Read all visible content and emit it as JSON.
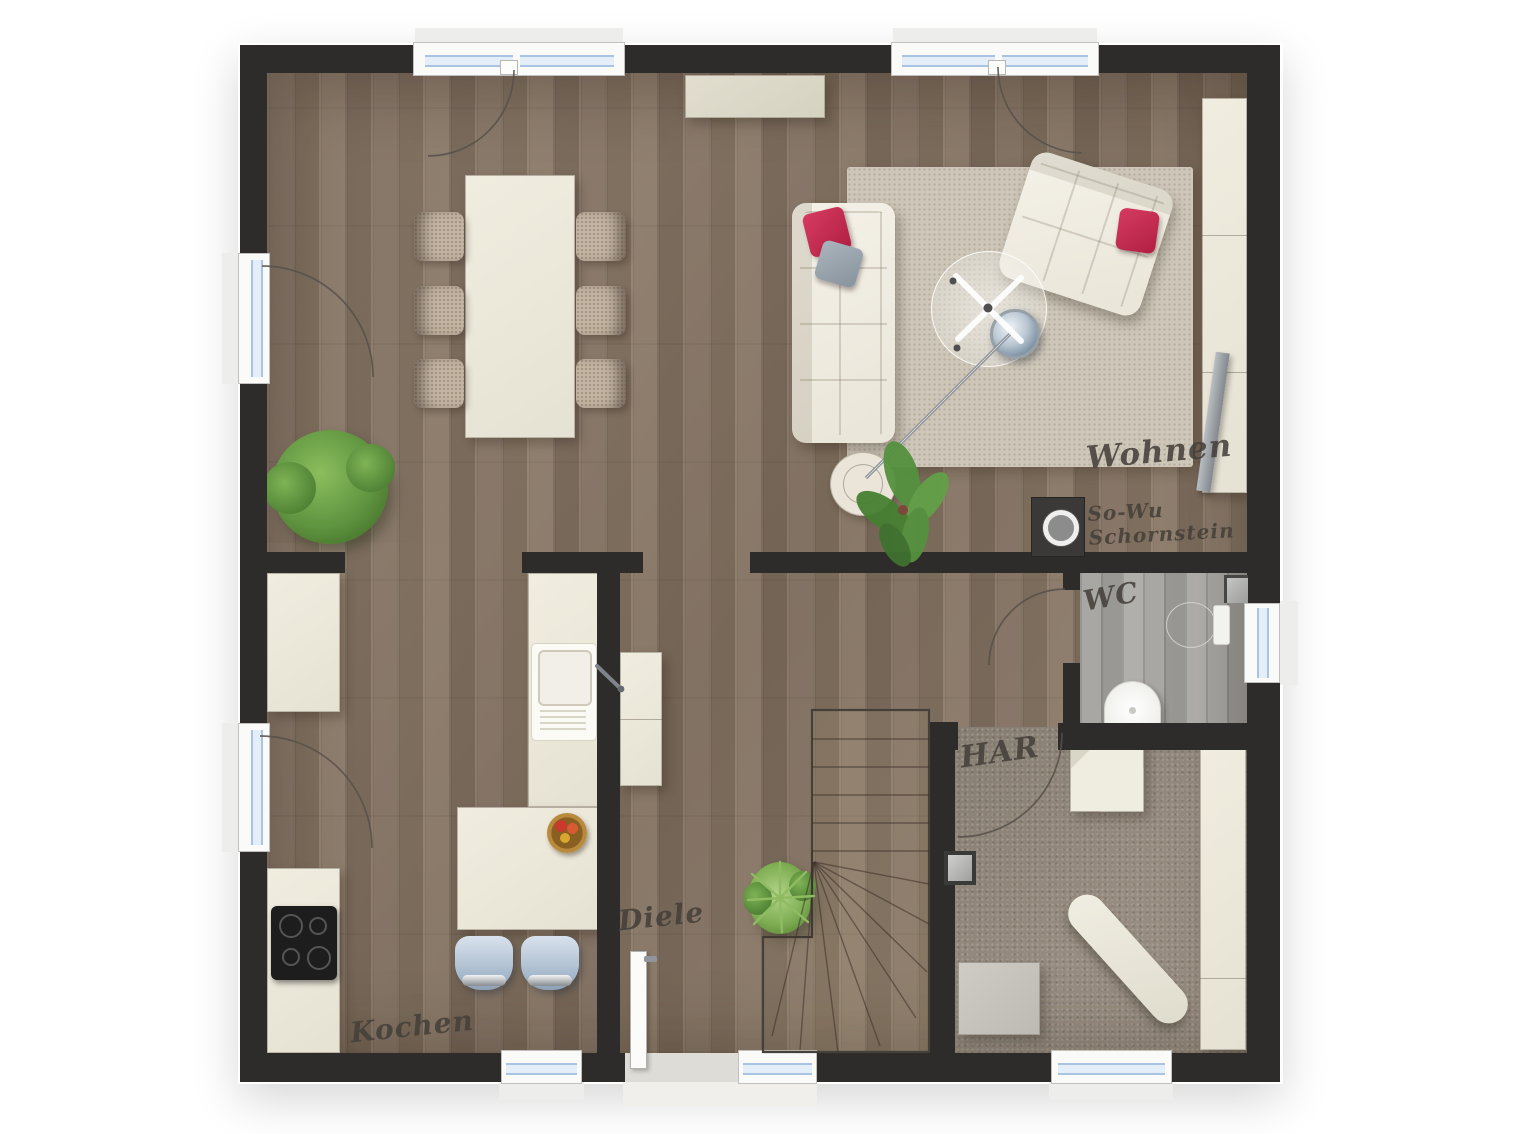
{
  "plan": {
    "type": "floor-plan-ground-floor",
    "rooms": [
      {
        "id": "wohnen",
        "label": "Wohnen"
      },
      {
        "id": "kochen",
        "label": "Kochen"
      },
      {
        "id": "diele",
        "label": "Diele"
      },
      {
        "id": "wc",
        "label": "WC"
      },
      {
        "id": "har",
        "label": "HAR"
      }
    ],
    "annotation": {
      "line1": "So-Wu",
      "line2": "Schornstein"
    }
  },
  "colors": {
    "wall": "#2e2c2a",
    "wood_floor": "#897767",
    "wc_floor": "#a5a3a0",
    "har_floor": "#968c7f",
    "rug": "#cec7b9",
    "furniture_cream": "#eeeadd",
    "accent_pillow": "#c62a50",
    "stool_blue": "#b9c9db",
    "plant_green": "#6aa04a",
    "window_glass": "#a9c4e2",
    "label_text": "#45403a"
  }
}
